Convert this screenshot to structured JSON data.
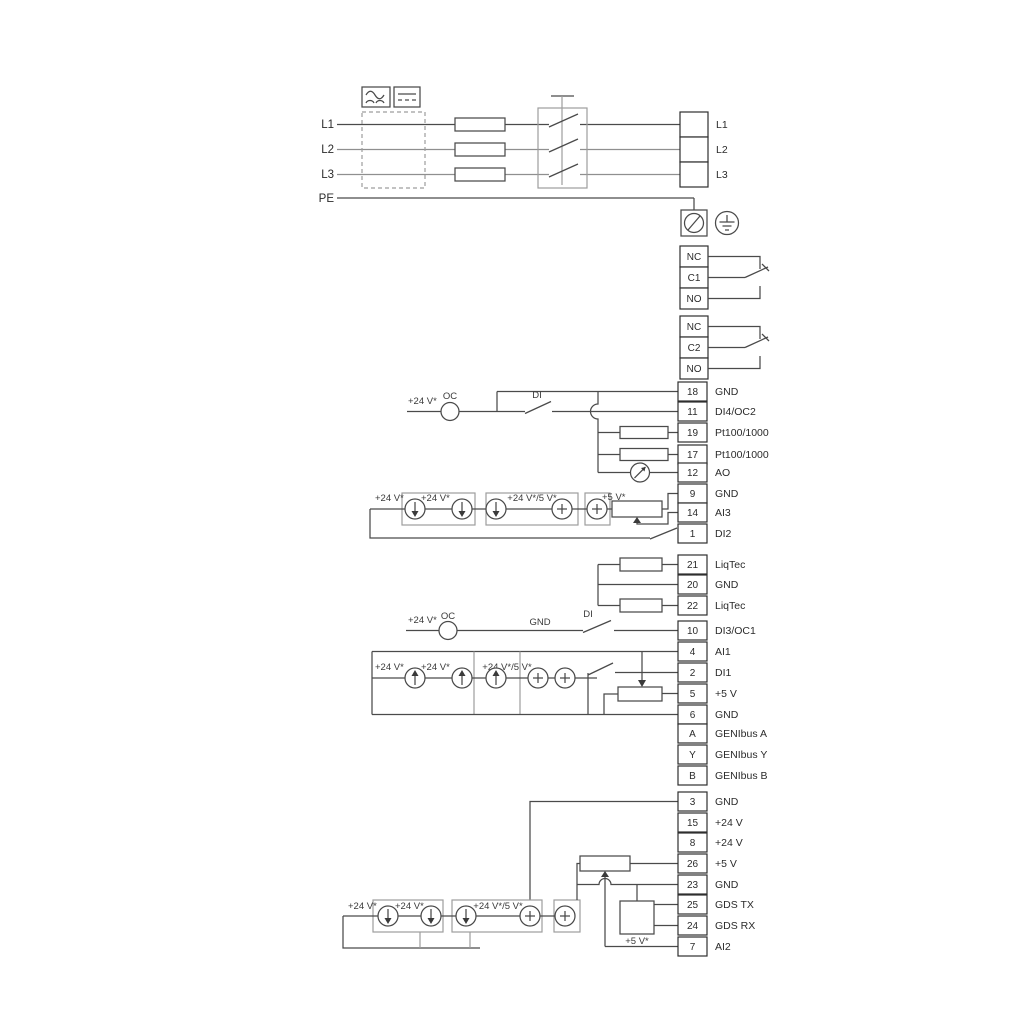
{
  "diagram_title": "Wiring diagram",
  "sym": {
    "v24": "+24 V*",
    "v24_5": "+24 V*/5 V*",
    "v5": "+5 V*",
    "oc": "OC",
    "di": "DI",
    "gnd": "GND"
  },
  "power": {
    "inputs": [
      "L1",
      "L2",
      "L3",
      "PE"
    ],
    "outputs": [
      "L1",
      "L2",
      "L3"
    ],
    "icons": [
      "ac-wave-icon",
      "dc-line-icon",
      "emc-filter-box",
      "fuse",
      "main-switch",
      "screw-terminal-icon",
      "earth-ground-icon"
    ]
  },
  "relay1": [
    "NC",
    "C1",
    "NO"
  ],
  "relay2": [
    "NC",
    "C2",
    "NO"
  ],
  "io1": [
    {
      "num": "18",
      "label": "GND"
    },
    {
      "num": "11",
      "label": "DI4/OC2"
    },
    {
      "num": "19",
      "label": "Pt100/1000"
    },
    {
      "num": "17",
      "label": "Pt100/1000"
    },
    {
      "num": "12",
      "label": "AO"
    },
    {
      "num": "9",
      "label": "GND"
    },
    {
      "num": "14",
      "label": "AI3"
    },
    {
      "num": "1",
      "label": "DI2"
    }
  ],
  "liqtec": [
    {
      "num": "21",
      "label": "LiqTec"
    },
    {
      "num": "20",
      "label": "GND"
    },
    {
      "num": "22",
      "label": "LiqTec"
    }
  ],
  "io2": [
    {
      "num": "10",
      "label": "DI3/OC1"
    },
    {
      "num": "4",
      "label": "AI1"
    },
    {
      "num": "2",
      "label": "DI1"
    },
    {
      "num": "5",
      "label": "+5 V"
    },
    {
      "num": "6",
      "label": "GND"
    }
  ],
  "genibus": [
    {
      "num": "A",
      "label": "GENIbus A"
    },
    {
      "num": "Y",
      "label": "GENIbus Y"
    },
    {
      "num": "B",
      "label": "GENIbus B"
    }
  ],
  "io3": [
    {
      "num": "3",
      "label": "GND"
    },
    {
      "num": "15",
      "label": "+24 V"
    },
    {
      "num": "8",
      "label": "+24 V"
    },
    {
      "num": "26",
      "label": "+5 V"
    },
    {
      "num": "23",
      "label": "GND"
    },
    {
      "num": "25",
      "label": "GDS TX"
    },
    {
      "num": "24",
      "label": "GDS RX"
    },
    {
      "num": "7",
      "label": "AI2"
    }
  ]
}
